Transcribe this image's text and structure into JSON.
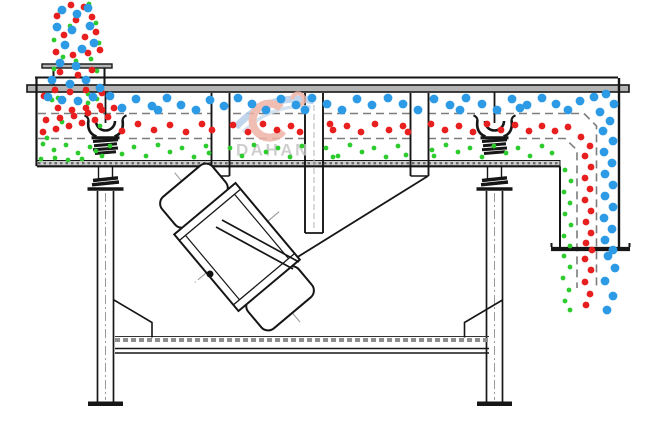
{
  "diagram": {
    "title": "linear-vibrating-screen-side-view",
    "watermark": {
      "brand": "DAHAN",
      "swirl_red": "#eeb3a6",
      "swirl_blue": "#b7cfe9",
      "text_color": "#c6c6c6"
    },
    "particles": {
      "groups": {
        "blue": {
          "label": "coarse particles (retained on top deck)",
          "color": "#2d9ae6",
          "radius": 4.4,
          "points": [
            [
              62,
              10
            ],
            [
              77,
              14
            ],
            [
              88,
              8
            ],
            [
              57,
              27
            ],
            [
              72,
              30
            ],
            [
              90,
              26
            ],
            [
              65,
              45
            ],
            [
              82,
              49
            ],
            [
              94,
              43
            ],
            [
              60,
              63
            ],
            [
              76,
              66
            ],
            [
              52,
              80
            ],
            [
              70,
              84
            ],
            [
              86,
              80
            ],
            [
              100,
              88
            ],
            [
              48,
              97
            ],
            [
              62,
              100
            ],
            [
              78,
              101
            ],
            [
              93,
              97
            ],
            [
              110,
              96
            ],
            [
              122,
              108
            ],
            [
              136,
              99
            ],
            [
              152,
              106
            ],
            [
              158,
              110
            ],
            [
              167,
              98
            ],
            [
              181,
              105
            ],
            [
              196,
              110
            ],
            [
              210,
              100
            ],
            [
              224,
              106
            ],
            [
              238,
              98
            ],
            [
              252,
              104
            ],
            [
              266,
              110
            ],
            [
              281,
              99
            ],
            [
              296,
              105
            ],
            [
              305,
              110
            ],
            [
              312,
              98
            ],
            [
              327,
              104
            ],
            [
              342,
              110
            ],
            [
              357,
              99
            ],
            [
              372,
              105
            ],
            [
              388,
              98
            ],
            [
              403,
              104
            ],
            [
              418,
              110
            ],
            [
              434,
              99
            ],
            [
              450,
              105
            ],
            [
              460,
              110
            ],
            [
              466,
              98
            ],
            [
              482,
              104
            ],
            [
              497,
              110
            ],
            [
              512,
              99
            ],
            [
              520,
              108
            ],
            [
              527,
              105
            ],
            [
              542,
              98
            ],
            [
              556,
              104
            ],
            [
              568,
              110
            ],
            [
              580,
              101
            ],
            [
              594,
              97
            ],
            [
              606,
              94
            ],
            [
              614,
              104
            ],
            [
              600,
              112
            ],
            [
              610,
              121
            ],
            [
              603,
              131
            ],
            [
              613,
              141
            ],
            [
              604,
              152
            ],
            [
              612,
              163
            ],
            [
              605,
              174
            ],
            [
              613,
              185
            ],
            [
              605,
              196
            ],
            [
              613,
              207
            ],
            [
              604,
              218
            ],
            [
              612,
              229
            ],
            [
              605,
              240
            ],
            [
              613,
              250
            ],
            [
              608,
              256
            ],
            [
              615,
              268
            ],
            [
              605,
              281
            ],
            [
              613,
              296
            ],
            [
              607,
              310
            ]
          ]
        },
        "red": {
          "label": "medium particles (middle deck)",
          "color": "#e81f1f",
          "radius": 3.4,
          "points": [
            [
              71,
              5
            ],
            [
              84,
              7
            ],
            [
              57,
              16
            ],
            [
              76,
              20
            ],
            [
              92,
              17
            ],
            [
              64,
              35
            ],
            [
              85,
              37
            ],
            [
              96,
              32
            ],
            [
              56,
              52
            ],
            [
              73,
              55
            ],
            [
              88,
              53
            ],
            [
              100,
              50
            ],
            [
              60,
              72
            ],
            [
              78,
              75
            ],
            [
              92,
              70
            ],
            [
              55,
              90
            ],
            [
              70,
              92
            ],
            [
              86,
              90
            ],
            [
              102,
              93
            ],
            [
              44,
              96
            ],
            [
              58,
              108
            ],
            [
              72,
              110
            ],
            [
              86,
              108
            ],
            [
              100,
              106
            ],
            [
              46,
              120
            ],
            [
              60,
              118
            ],
            [
              74,
              116
            ],
            [
              88,
              113
            ],
            [
              102,
              110
            ],
            [
              114,
              108
            ],
            [
              43,
              132
            ],
            [
              56,
              129
            ],
            [
              69,
              126
            ],
            [
              82,
              123
            ],
            [
              95,
              120
            ],
            [
              108,
              117
            ],
            [
              122,
              131
            ],
            [
              138,
              124
            ],
            [
              154,
              130
            ],
            [
              170,
              125
            ],
            [
              186,
              132
            ],
            [
              202,
              124
            ],
            [
              212,
              130
            ],
            [
              233,
              125
            ],
            [
              248,
              132
            ],
            [
              263,
              124
            ],
            [
              277,
              130
            ],
            [
              291,
              126
            ],
            [
              300,
              132
            ],
            [
              330,
              124
            ],
            [
              333,
              130
            ],
            [
              347,
              126
            ],
            [
              361,
              132
            ],
            [
              375,
              124
            ],
            [
              389,
              130
            ],
            [
              403,
              126
            ],
            [
              408,
              132
            ],
            [
              431,
              124
            ],
            [
              445,
              130
            ],
            [
              459,
              126
            ],
            [
              473,
              132
            ],
            [
              487,
              124
            ],
            [
              501,
              130
            ],
            [
              515,
              125
            ],
            [
              529,
              131
            ],
            [
              542,
              126
            ],
            [
              555,
              131
            ],
            [
              568,
              127
            ],
            [
              581,
              137
            ],
            [
              590,
              146
            ],
            [
              585,
              156
            ],
            [
              591,
              167
            ],
            [
              585,
              178
            ],
            [
              590,
              189
            ],
            [
              585,
              200
            ],
            [
              591,
              211
            ],
            [
              586,
              222
            ],
            [
              591,
              233
            ],
            [
              586,
              243
            ],
            [
              592,
              250
            ],
            [
              585,
              259
            ],
            [
              591,
              270
            ],
            [
              585,
              282
            ],
            [
              590,
              294
            ],
            [
              586,
              305
            ]
          ]
        },
        "green": {
          "label": "fine particles (bottom pan)",
          "color": "#2ecb2e",
          "radius": 2.4,
          "points": [
            [
              89,
              4
            ],
            [
              60,
              11
            ],
            [
              96,
              23
            ],
            [
              70,
              26
            ],
            [
              54,
              40
            ],
            [
              99,
              43
            ],
            [
              63,
              57
            ],
            [
              91,
              59
            ],
            [
              76,
              61
            ],
            [
              54,
              69
            ],
            [
              97,
              71
            ],
            [
              68,
              84
            ],
            [
              88,
              94
            ],
            [
              58,
              98
            ],
            [
              97,
              99
            ],
            [
              52,
              100
            ],
            [
              88,
              103
            ],
            [
              62,
              122
            ],
            [
              100,
              126
            ],
            [
              47,
              138
            ],
            [
              43,
              144
            ],
            [
              54,
              150
            ],
            [
              66,
              145
            ],
            [
              78,
              153
            ],
            [
              90,
              147
            ],
            [
              102,
              156
            ],
            [
              41,
              159
            ],
            [
              55,
              158
            ],
            [
              68,
              160
            ],
            [
              82,
              159
            ],
            [
              96,
              151
            ],
            [
              110,
              146
            ],
            [
              122,
              154
            ],
            [
              134,
              147
            ],
            [
              146,
              156
            ],
            [
              158,
              145
            ],
            [
              170,
              152
            ],
            [
              182,
              148
            ],
            [
              194,
              157
            ],
            [
              206,
              146
            ],
            [
              209,
              153
            ],
            [
              230,
              148
            ],
            [
              242,
              156
            ],
            [
              254,
              145
            ],
            [
              266,
              152
            ],
            [
              278,
              148
            ],
            [
              290,
              157
            ],
            [
              302,
              146
            ],
            [
              333,
              157
            ],
            [
              326,
              148
            ],
            [
              338,
              156
            ],
            [
              350,
              145
            ],
            [
              362,
              152
            ],
            [
              374,
              148
            ],
            [
              386,
              157
            ],
            [
              398,
              146
            ],
            [
              406,
              155
            ],
            [
              432,
              150
            ],
            [
              434,
              156
            ],
            [
              446,
              145
            ],
            [
              458,
              152
            ],
            [
              470,
              148
            ],
            [
              482,
              157
            ],
            [
              494,
              146
            ],
            [
              506,
              153
            ],
            [
              518,
              148
            ],
            [
              530,
              156
            ],
            [
              542,
              146
            ],
            [
              552,
              153
            ],
            [
              565,
              170
            ],
            [
              571,
              181
            ],
            [
              564,
              192
            ],
            [
              570,
              203
            ],
            [
              565,
              214
            ],
            [
              571,
              225
            ],
            [
              564,
              236
            ],
            [
              570,
              246
            ],
            [
              564,
              256
            ],
            [
              570,
              267
            ],
            [
              563,
              278
            ],
            [
              569,
              290
            ],
            [
              565,
              301
            ],
            [
              570,
              310
            ]
          ]
        }
      }
    }
  }
}
